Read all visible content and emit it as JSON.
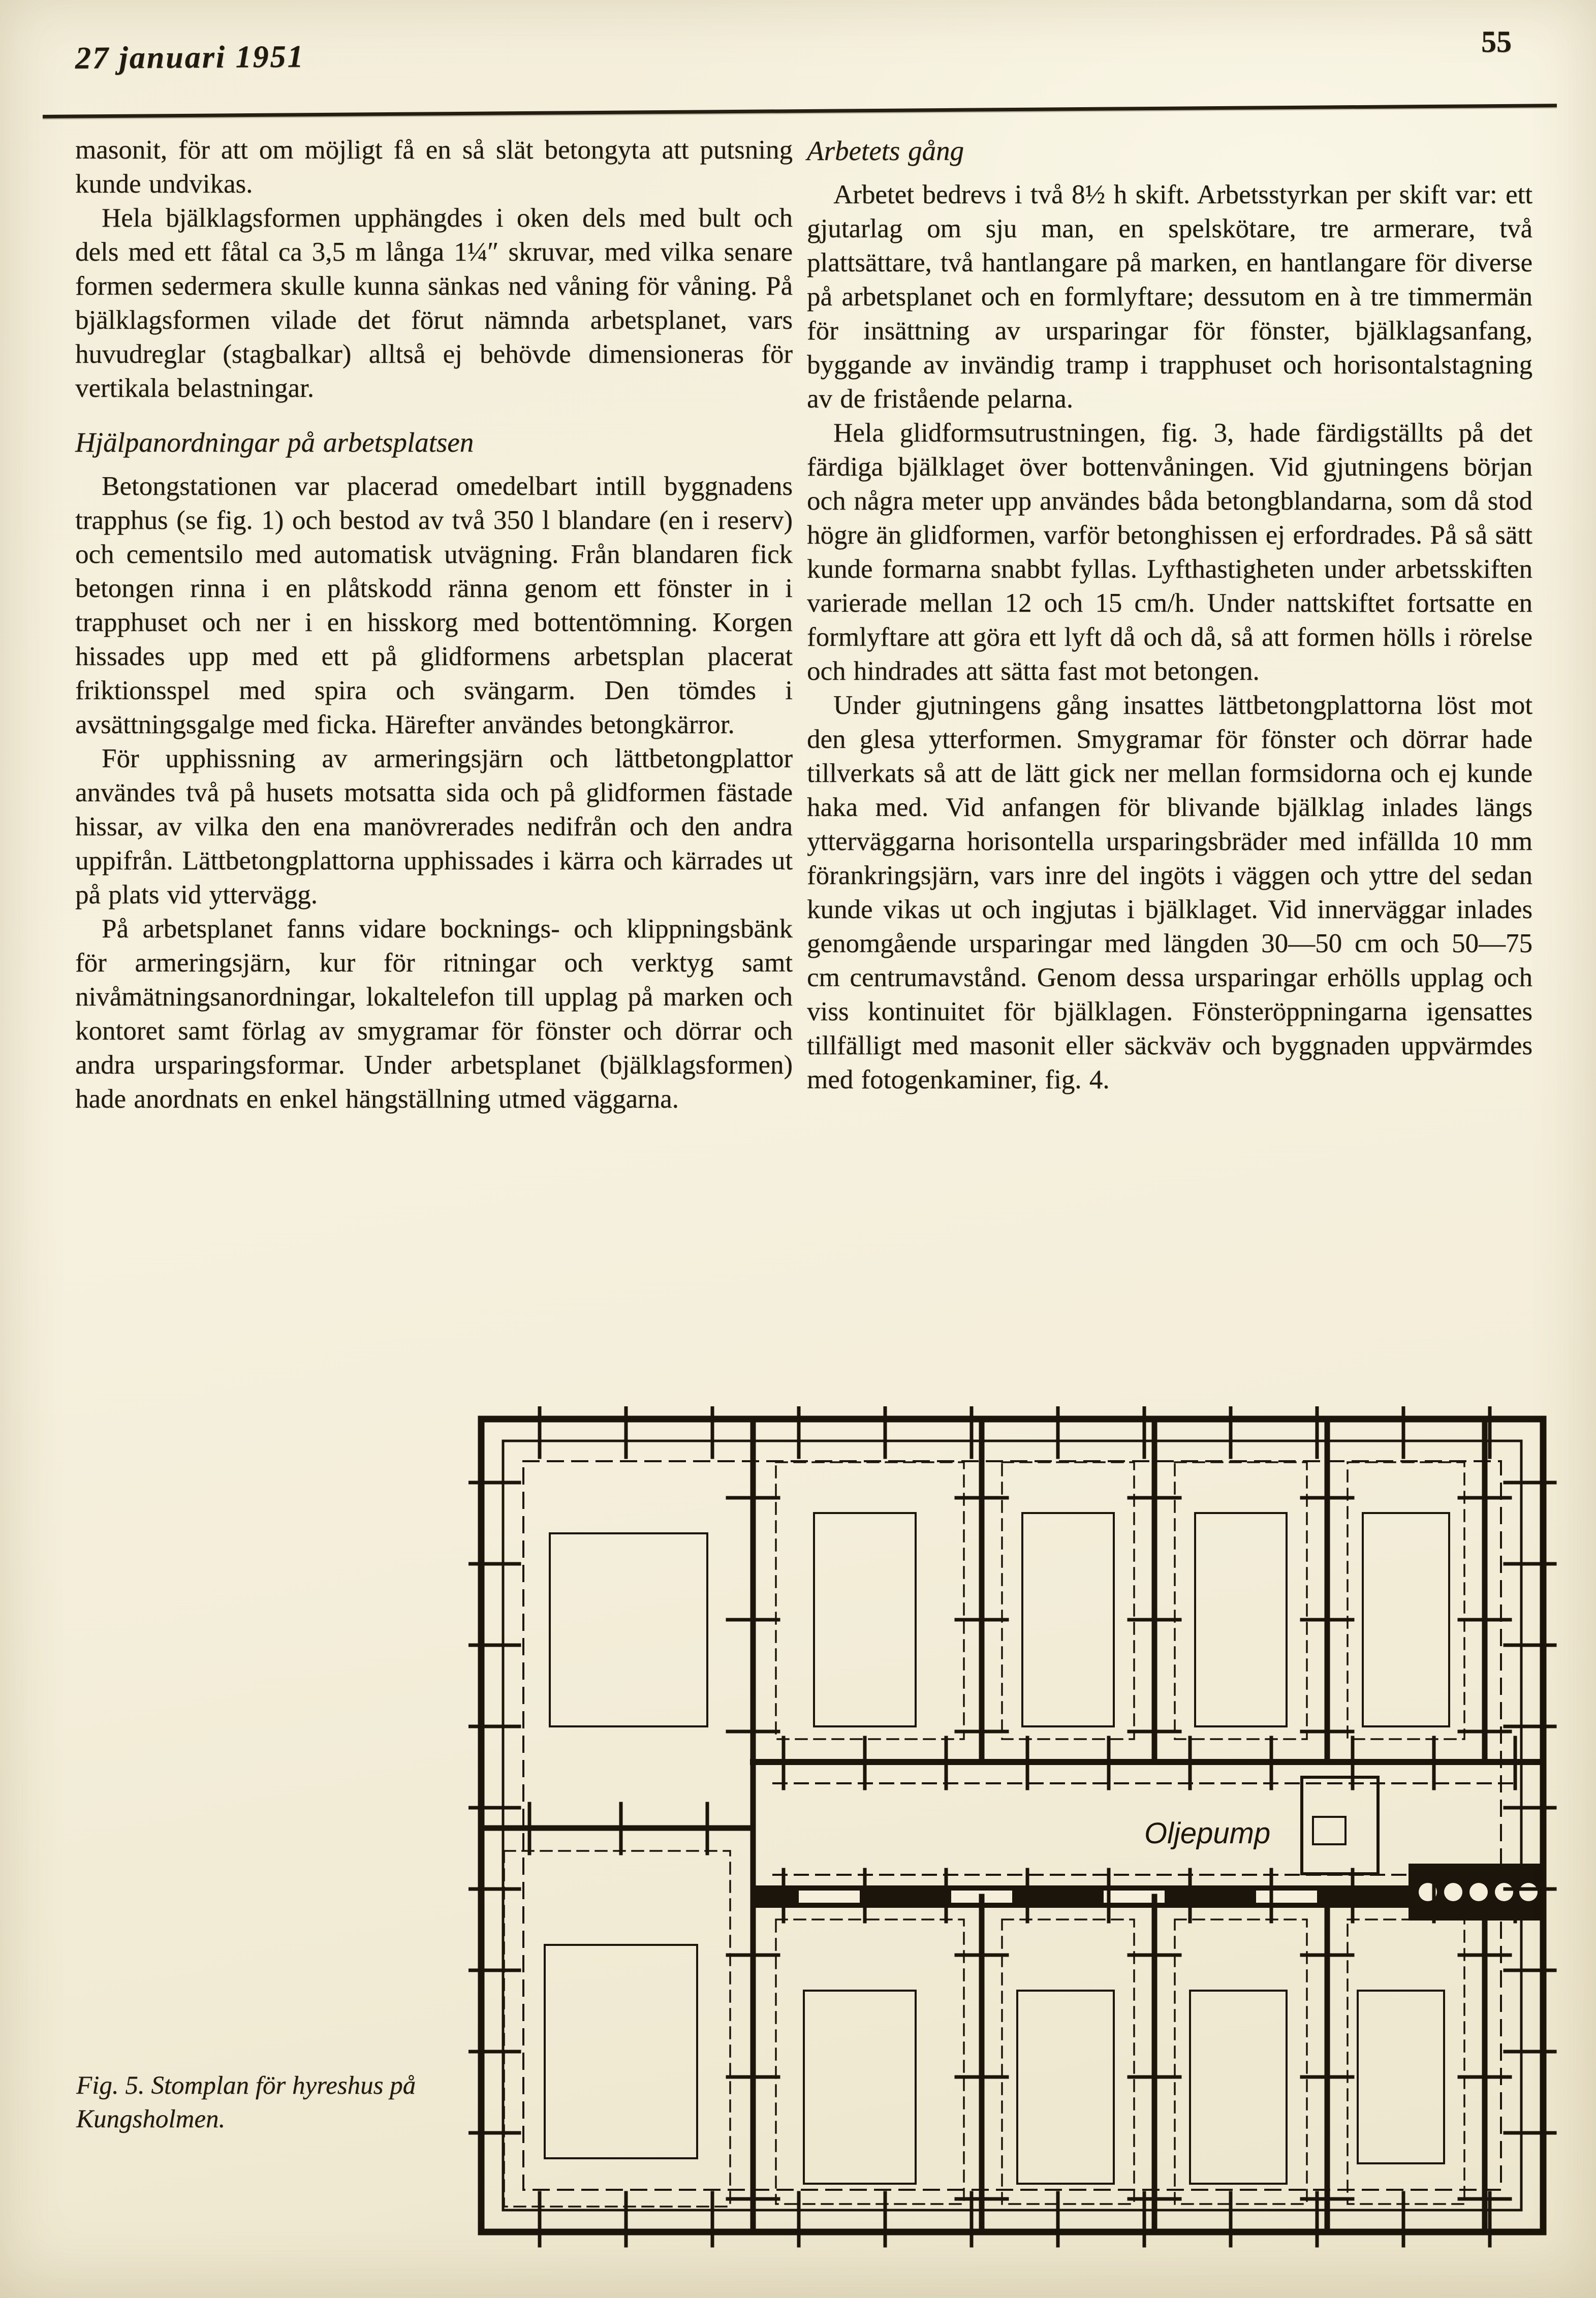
{
  "page": {
    "header": {
      "date": "27 januari 1951",
      "page_number": "55"
    },
    "left_column": {
      "para_1": "masonit, för att om möjligt få en så slät betongyta att putsning kunde undvikas.",
      "para_2": "Hela bjälklagsformen upphängdes i oken dels med bult och dels med ett fåtal ca 3,5 m långa 1¼″ skruvar, med vilka senare formen sedermera skulle kunna sänkas ned våning för våning. På bjälklagsformen vilade det förut nämnda arbetsplanet, vars huvudreglar (stagbalkar) alltså ej behövde dimensioneras för vertikala belastningar.",
      "heading": "Hjälpanordningar på arbetsplatsen",
      "para_3": "Betongstationen var placerad omedelbart intill byggnadens trapphus (se fig. 1) och bestod av två 350 l blandare (en i reserv) och cementsilo med automatisk utvägning. Från blandaren fick betongen rinna i en plåtskodd ränna genom ett fönster in i trapphuset och ner i en hisskorg med bottentömning. Korgen hissades upp med ett på glidformens arbetsplan placerat friktionsspel med spira och svängarm. Den tömdes i avsättningsgalge med ficka. Härefter användes betongkärror.",
      "para_4": "För upphissning av armeringsjärn och lättbetongplattor användes två på husets motsatta sida och på glidformen fästade hissar, av vilka den ena manövrerades nedifrån och den andra uppifrån. Lättbetongplattorna upphissades i kärra och kärrades ut på plats vid yttervägg.",
      "para_5": "På arbetsplanet fanns vidare bocknings- och klippningsbänk för armeringsjärn, kur för ritningar och verktyg samt nivåmätningsanordningar, lokaltelefon till upplag på marken och kontoret samt förlag av smygramar för fönster och dörrar och andra ursparingsformar. Under arbetsplanet (bjälklagsformen) hade anordnats en enkel hängställning utmed väggarna."
    },
    "right_column": {
      "heading": "Arbetets gång",
      "para_1": "Arbetet bedrevs i två 8½ h skift. Arbetsstyrkan per skift var: ett gjutarlag om sju man, en spelskötare, tre armerare, två plattsättare, två hantlangare på marken, en hantlangare för diverse på arbetsplanet och en formlyftare; dessutom en à tre timmermän för insättning av ursparingar för fönster, bjälklagsanfang, byggande av invändig tramp i trapphuset och horisontalstagning av de fristående pelarna.",
      "para_2": "Hela glidformsutrustningen, fig. 3, hade färdigställts på det färdiga bjälklaget över bottenvåningen. Vid gjutningens början och några meter upp användes båda betongblandarna, som då stod högre än glidformen, varför betonghissen ej erfordrades. På så sätt kunde formarna snabbt fyllas. Lyfthastigheten under arbetsskiften varierade mellan 12 och 15 cm/h. Under nattskiftet fortsatte en formlyftare att göra ett lyft då och då, så att formen hölls i rörelse och hindrades att sätta fast mot betongen.",
      "para_3": "Under gjutningens gång insattes lättbetongplattorna löst mot den glesa ytterformen. Smygramar för fönster och dörrar hade tillverkats så att de lätt gick ner mellan formsidorna och ej kunde haka med. Vid anfangen för blivande bjälklag inlades längs ytterväggarna horisontella ursparingsbräder med infällda 10 mm förankringsjärn, vars inre del ingöts i väggen och yttre del sedan kunde vikas ut och ingjutas i bjälklaget. Vid innerväggar inlades genomgående ursparingar med längden 30—50 cm och 50—75 cm centrumavstånd. Genom dessa ursparingar erhölls upplag och viss kontinuitet för bjälklagen. Fönsteröppningarna igensattes tillfälligt med masonit eller säckväv och byggnaden uppvärmdes med fotogenkaminer, fig. 4."
    },
    "figure": {
      "caption": "Fig. 5. Stomplan för hyreshus på Kungsholmen.",
      "plan_label": "Oljepump"
    },
    "colors": {
      "paper": "#f4eedb",
      "ink": "#201a10"
    }
  }
}
